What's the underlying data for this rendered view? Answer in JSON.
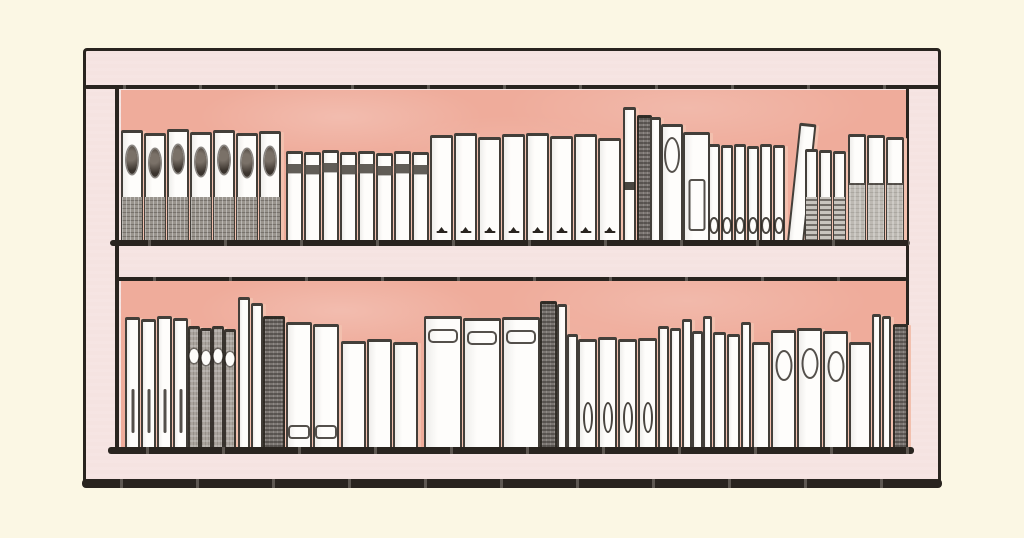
{
  "scene": {
    "description": "Hand-drawn illustration of a pale pink wooden bookshelf on a cream background. Two shelves with a salmon back panel hold rows of sketchy white, gray and dark book spines decorated with small ovals, labels and glyphs. No text is visible."
  },
  "palette": {
    "bg": "#FBF7E4",
    "frame": "#F5E3E1",
    "panel": "#EFAC9B",
    "ink": "#29241F",
    "book": "#FEFDFB",
    "shadow": "#F2C0AE"
  },
  "shelves": [
    {
      "id": "top",
      "books": [
        {
          "style": "medallion",
          "n": 7,
          "x": 0,
          "step": 23,
          "w": 22,
          "h": 112,
          "hs": [
            112,
            109,
            113,
            110,
            112,
            109,
            111
          ]
        },
        {
          "style": "band",
          "n": 8,
          "x": 165,
          "step": 18,
          "w": 17,
          "h": 91,
          "hs": [
            91,
            90,
            92,
            90,
            91,
            89,
            91,
            90
          ]
        },
        {
          "style": "glyph",
          "n": 8,
          "x": 309,
          "step": 24,
          "w": 23,
          "h": 108,
          "hs": [
            107,
            109,
            105,
            108,
            109,
            106,
            108,
            104
          ]
        },
        {
          "style": "white-tick",
          "x": 502,
          "w": 13,
          "h": 135
        },
        {
          "style": "dark",
          "x": 516,
          "w": 15,
          "h": 127
        },
        {
          "style": "plain",
          "x": 529,
          "w": 11,
          "h": 125
        },
        {
          "style": "oval-mid",
          "x": 540,
          "w": 22,
          "h": 118
        },
        {
          "style": "rect-label",
          "x": 562,
          "w": 27,
          "h": 110
        },
        {
          "style": "oval-s",
          "n": 6,
          "x": 587,
          "step": 13,
          "w": 12,
          "h": 98,
          "hs": [
            98,
            97,
            98,
            96,
            98,
            97
          ]
        },
        {
          "style": "plain",
          "x": 666,
          "w": 17,
          "h": 120,
          "tilt": 6
        },
        {
          "style": "hatch-bottom",
          "n": 3,
          "x": 684,
          "step": 14,
          "w": 13,
          "h": 93,
          "hs": [
            93,
            92,
            91
          ]
        },
        {
          "style": "gray-bottom",
          "n": 3,
          "x": 727,
          "step": 19,
          "w": 18,
          "h": 108,
          "hs": [
            108,
            107,
            105
          ]
        }
      ]
    },
    {
      "id": "bottom",
      "books": [
        {
          "style": "tick",
          "n": 4,
          "x": 4,
          "step": 16,
          "w": 15,
          "h": 132,
          "hs": [
            132,
            130,
            133,
            131
          ]
        },
        {
          "style": "gray-oval",
          "n": 4,
          "x": 67,
          "step": 12,
          "w": 12,
          "h": 123,
          "hs": [
            123,
            121,
            123,
            120
          ]
        },
        {
          "style": "plain",
          "x": 117,
          "w": 12,
          "h": 152
        },
        {
          "style": "plain",
          "x": 130,
          "w": 12,
          "h": 146
        },
        {
          "style": "dark",
          "x": 142,
          "w": 22,
          "h": 133
        },
        {
          "style": "tab-bottom",
          "n": 2,
          "x": 165,
          "step": 27,
          "w": 26,
          "h": 127,
          "hs": [
            127,
            125
          ]
        },
        {
          "style": "plain",
          "n": 3,
          "x": 220,
          "step": 26,
          "w": 25,
          "h": 108,
          "hs": [
            108,
            110,
            107
          ]
        },
        {
          "style": "tab-top",
          "n": 3,
          "x": 303,
          "step": 39,
          "w": 38,
          "h": 133,
          "hs": [
            133,
            131,
            132
          ]
        },
        {
          "style": "dark",
          "x": 419,
          "w": 17,
          "h": 148
        },
        {
          "style": "plain",
          "x": 436,
          "w": 10,
          "h": 145
        },
        {
          "style": "plain",
          "x": 446,
          "w": 11,
          "h": 115
        },
        {
          "style": "oval-b",
          "n": 4,
          "x": 457,
          "step": 20,
          "w": 19,
          "h": 110,
          "hs": [
            110,
            112,
            110,
            111
          ]
        },
        {
          "style": "plain",
          "n": 2,
          "x": 537,
          "step": 12,
          "w": 11,
          "h": 123,
          "hs": [
            123,
            121
          ]
        },
        {
          "style": "plain",
          "x": 561,
          "w": 10,
          "h": 130
        },
        {
          "style": "plain",
          "x": 571,
          "w": 11,
          "h": 118
        },
        {
          "style": "plain",
          "x": 582,
          "w": 9,
          "h": 133
        },
        {
          "style": "plain",
          "n": 2,
          "x": 592,
          "step": 14,
          "w": 13,
          "h": 117,
          "hs": [
            117,
            115
          ]
        },
        {
          "style": "plain",
          "x": 620,
          "w": 10,
          "h": 127
        },
        {
          "style": "plain",
          "x": 631,
          "w": 18,
          "h": 107
        },
        {
          "style": "oval-top",
          "n": 3,
          "x": 650,
          "step": 26,
          "w": 25,
          "h": 119,
          "hs": [
            119,
            121,
            118
          ]
        },
        {
          "style": "plain",
          "x": 728,
          "w": 22,
          "h": 107
        },
        {
          "style": "plain",
          "n": 2,
          "x": 751,
          "step": 10,
          "w": 9,
          "h": 135,
          "hs": [
            135,
            133
          ]
        },
        {
          "style": "dark",
          "x": 772,
          "w": 15,
          "h": 125
        }
      ]
    }
  ]
}
